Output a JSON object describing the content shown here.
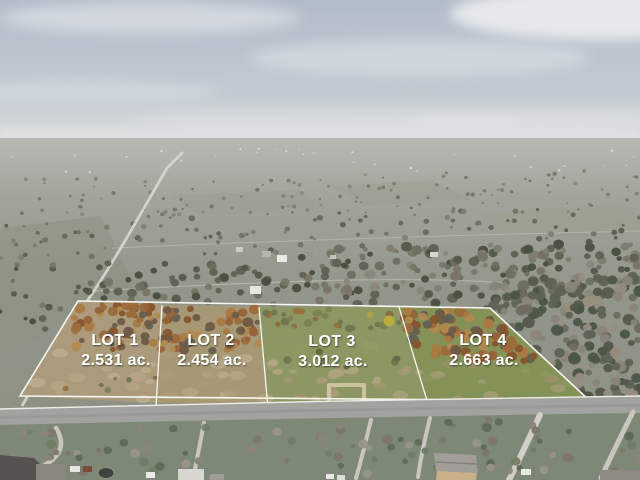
{
  "photo": {
    "kind": "aerial-drone-photo-of-subdivided-land",
    "lots": [
      {
        "name": "LOT 1",
        "acreage": "2.531 ac."
      },
      {
        "name": "LOT 2",
        "acreage": "2.454 ac."
      },
      {
        "name": "LOT 3",
        "acreage": "3.012 ac."
      },
      {
        "name": "LOT 4",
        "acreage": "2.663 ac."
      }
    ],
    "colors": {
      "label_text": "#ffffff",
      "boundary_line": "#f7f6f0",
      "sky_top": "#b2bbc8",
      "sky_horizon": "#dadddd",
      "far_field": "#a6a89f",
      "field": "#91948a",
      "lot_grass": "#8a9562",
      "lot_soil": "#b0a07f",
      "autumn_canopy": "#a06f3d",
      "road": "#a2a29e",
      "residential_grass": "#7e8876"
    }
  }
}
